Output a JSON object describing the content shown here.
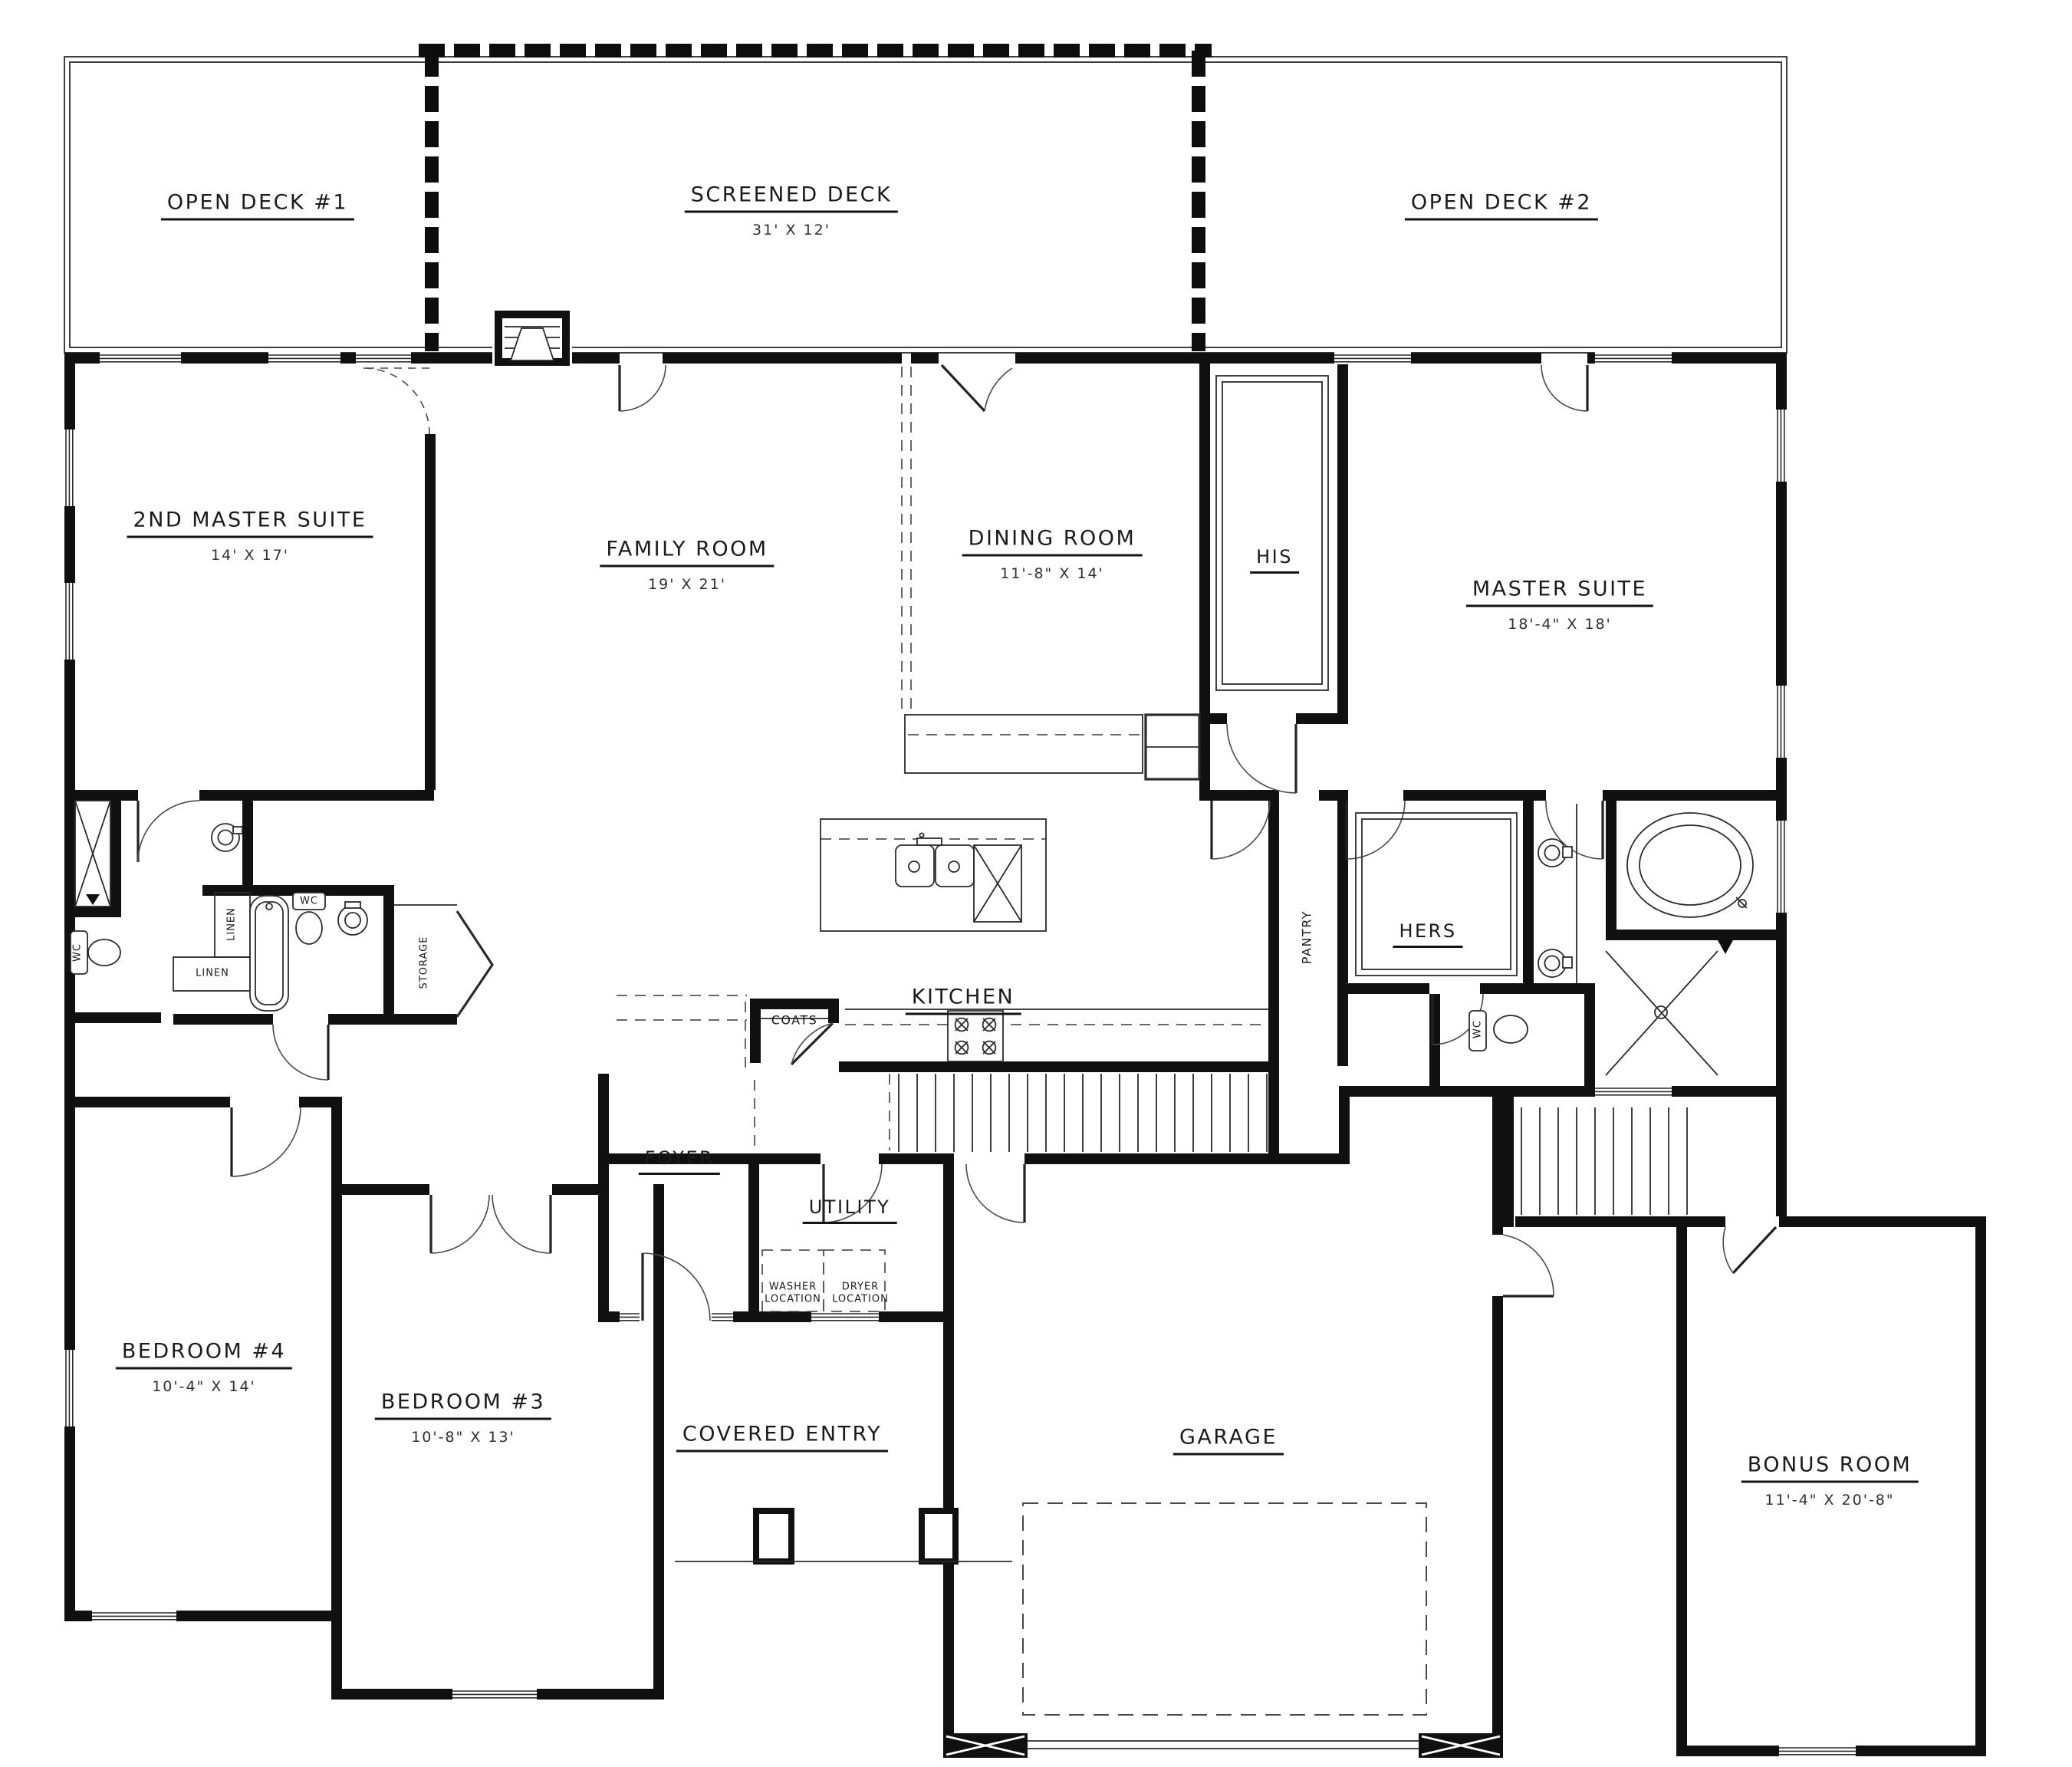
{
  "style": {
    "wall_color": "#101010",
    "line_color": "#2b2b2b",
    "background": "#ffffff"
  },
  "rooms": {
    "open_deck_1": {
      "name": "OPEN DECK #1"
    },
    "screened_deck": {
      "name": "SCREENED DECK",
      "dims": "31' X 12'"
    },
    "open_deck_2": {
      "name": "OPEN DECK #2"
    },
    "second_master_suite": {
      "name": "2ND MASTER SUITE",
      "dims": "14' X 17'"
    },
    "family_room": {
      "name": "FAMILY ROOM",
      "dims": "19' X 21'"
    },
    "dining_room": {
      "name": "DINING ROOM",
      "dims": "11'-8\" X 14'"
    },
    "his_closet": {
      "name": "HIS"
    },
    "master_suite": {
      "name": "MASTER SUITE",
      "dims": "18'-4\" X 18'"
    },
    "kitchen": {
      "name": "KITCHEN"
    },
    "hers_closet": {
      "name": "HERS"
    },
    "pantry": {
      "name": "PANTRY"
    },
    "linen_1": {
      "name": "LINEN"
    },
    "linen_2": {
      "name": "LINEN"
    },
    "wc_1": {
      "name": "WC"
    },
    "wc_2": {
      "name": "WC"
    },
    "wc_3": {
      "name": "WC"
    },
    "storage": {
      "name": "STORAGE"
    },
    "coats": {
      "name": "COATS"
    },
    "foyer": {
      "name": "FOYER"
    },
    "utility": {
      "name": "UTILITY"
    },
    "washer": {
      "name": "WASHER LOCATION"
    },
    "dryer": {
      "name": "DRYER LOCATION"
    },
    "bedroom_4": {
      "name": "BEDROOM #4",
      "dims": "10'-4\" X 14'"
    },
    "bedroom_3": {
      "name": "BEDROOM #3",
      "dims": "10'-8\" X 13'"
    },
    "covered_entry": {
      "name": "COVERED ENTRY"
    },
    "garage": {
      "name": "GARAGE"
    },
    "bonus_room": {
      "name": "BONUS ROOM",
      "dims": "11'-4\" X 20'-8\""
    }
  }
}
